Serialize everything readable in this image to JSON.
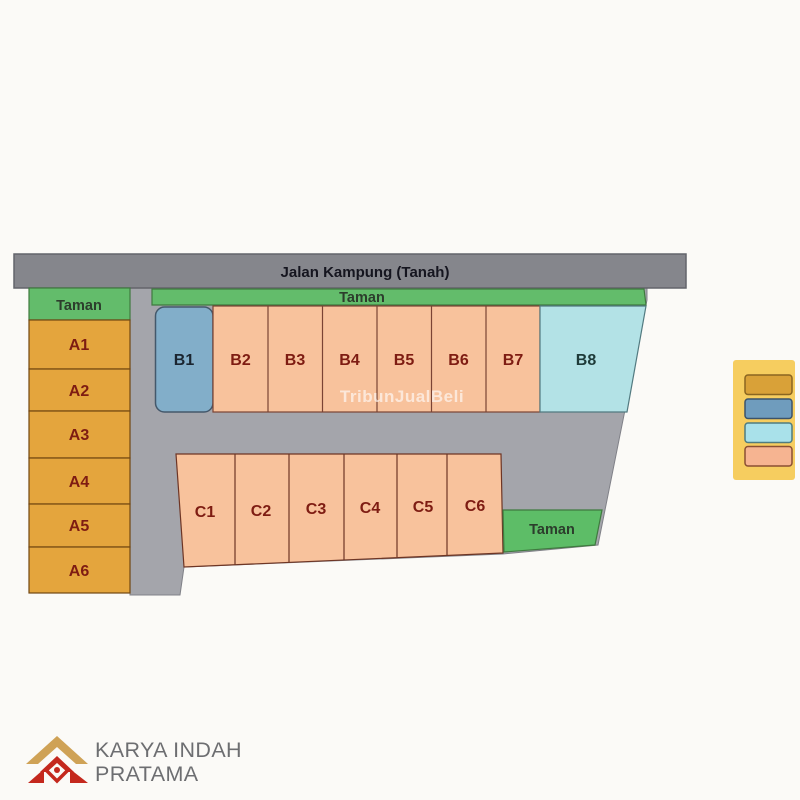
{
  "site_plan": {
    "road_label": "Jalan Kampung (Tanah)",
    "parks": {
      "left": "Taman",
      "top": "Taman",
      "bottom_right": "Taman"
    },
    "lots_a": [
      "A1",
      "A2",
      "A3",
      "A4",
      "A5",
      "A6"
    ],
    "lots_b": [
      "B1",
      "B2",
      "B3",
      "B4",
      "B5",
      "B6",
      "B7",
      "B8"
    ],
    "lots_c": [
      "C1",
      "C2",
      "C3",
      "C4",
      "C5",
      "C6"
    ]
  },
  "legend": {
    "background": "#f6cd5f",
    "swatches": [
      {
        "name": "orange-lot-type",
        "color": "#d9a138"
      },
      {
        "name": "blue-lot-type",
        "color": "#6f9cbd"
      },
      {
        "name": "cyan-lot-type",
        "color": "#a9e1ea"
      },
      {
        "name": "peach-lot-type",
        "color": "#f6b491"
      }
    ]
  },
  "watermark": "TribunJualBeli",
  "branding": {
    "company_line1": "KARYA INDAH",
    "company_line2": "PRATAMA"
  },
  "colors": {
    "road_gray": "#85868c",
    "inner_road_gray": "#a4a5ab",
    "park_green": "#63bc6b",
    "park_green_bright": "#5dbd67",
    "lot_orange": "#e4a53d",
    "lot_blue": "#82aec9",
    "lot_cyan": "#b3e2e6",
    "lot_peach": "#f8c29c",
    "label_maroon": "#7e1c12",
    "logo_gold": "#cfa256",
    "logo_red": "#c4281d"
  }
}
